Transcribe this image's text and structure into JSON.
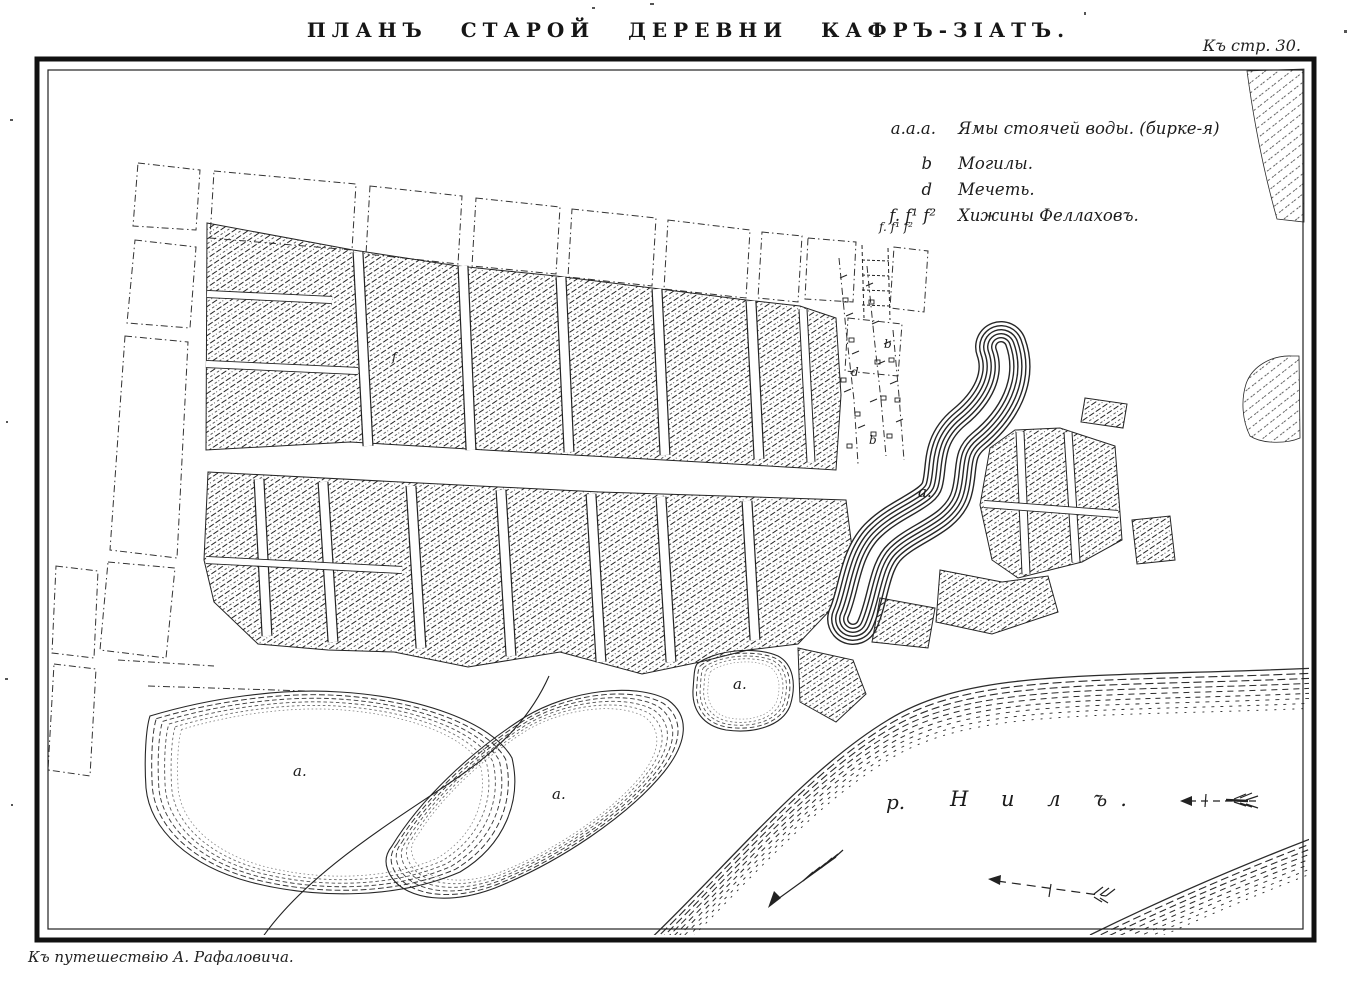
{
  "page": {
    "title": "ПЛАНЪ СТАРОЙ ДЕРЕВНИ КАФРЪ-ЗІАТЪ.",
    "page_ref": "Къ стр. 30.",
    "caption": "Къ путешествію А. Рафаловича."
  },
  "legend": {
    "items": [
      {
        "symbol": "a.a.a.",
        "label": "Ямы стоячей воды. (бирке-я)"
      },
      {
        "symbol": "b",
        "label": "Могилы."
      },
      {
        "symbol": "d",
        "label": "Мечеть."
      },
      {
        "symbol": "f. f¹ f²",
        "label": "Хижины Феллаховъ."
      }
    ]
  },
  "map": {
    "river": {
      "abbr": "р.",
      "name": "Н и л ъ."
    },
    "pond_labels": [
      "a.",
      "a.",
      "a.",
      "a."
    ],
    "letters": {
      "b_upper": "b",
      "d_mosque": "d",
      "b_lower": "b",
      "f_row": "f. f¹ f²",
      "f_single": "f"
    }
  },
  "colors": {
    "ink": "#1f1f1f",
    "paper": "#ffffff"
  }
}
